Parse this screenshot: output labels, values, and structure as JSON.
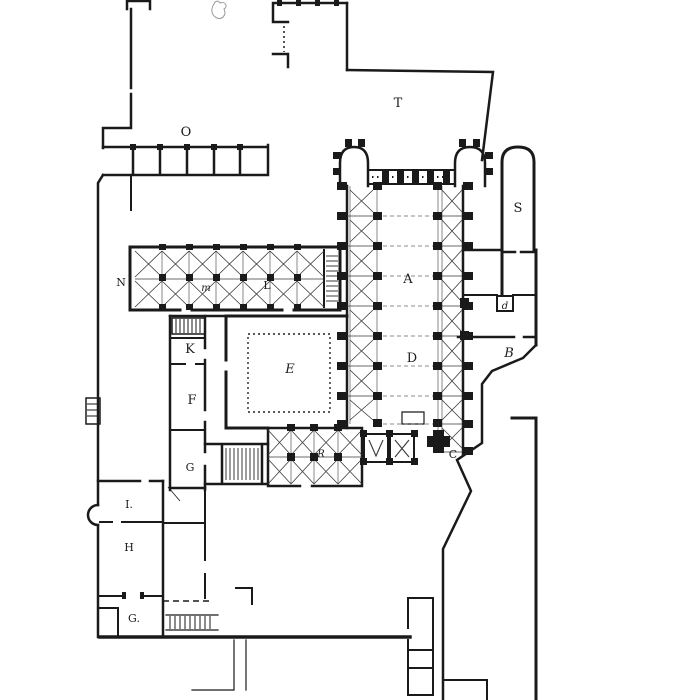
{
  "plan": {
    "labels": [
      {
        "text": "O"
      },
      {
        "text": "T"
      },
      {
        "text": "S"
      },
      {
        "text": "N"
      },
      {
        "text": "m"
      },
      {
        "text": "L"
      },
      {
        "text": "A"
      },
      {
        "text": "K"
      },
      {
        "text": "E"
      },
      {
        "text": "D"
      },
      {
        "text": "B"
      },
      {
        "text": "d"
      },
      {
        "text": "F"
      },
      {
        "text": "G"
      },
      {
        "text": "R"
      },
      {
        "text": "C"
      },
      {
        "text": "I."
      },
      {
        "text": "H"
      },
      {
        "text": "G."
      }
    ]
  },
  "colors": {
    "ink": "#1a1a1a",
    "paper": "#ffffff",
    "faint": "#999999"
  }
}
